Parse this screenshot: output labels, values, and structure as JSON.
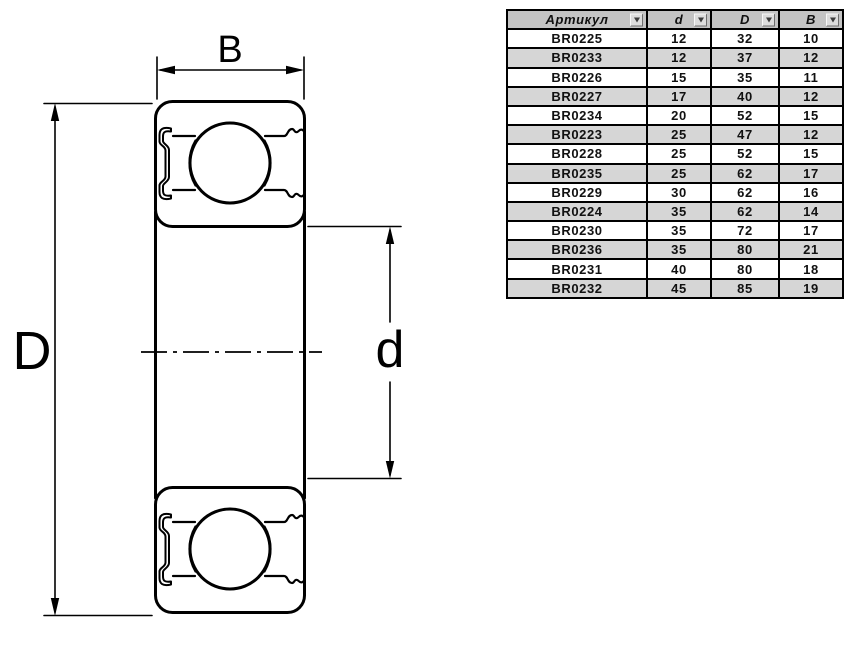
{
  "diagram": {
    "dimension_labels": {
      "width": "B",
      "outer_diameter": "D",
      "bore": "d"
    },
    "line_color": "#000000"
  },
  "table": {
    "columns": [
      "Артикул",
      "d",
      "D",
      "B"
    ],
    "rows": [
      [
        "BR0225",
        "12",
        "32",
        "10"
      ],
      [
        "BR0233",
        "12",
        "37",
        "12"
      ],
      [
        "BR0226",
        "15",
        "35",
        "11"
      ],
      [
        "BR0227",
        "17",
        "40",
        "12"
      ],
      [
        "BR0234",
        "20",
        "52",
        "15"
      ],
      [
        "BR0223",
        "25",
        "47",
        "12"
      ],
      [
        "BR0228",
        "25",
        "52",
        "15"
      ],
      [
        "BR0235",
        "25",
        "62",
        "17"
      ],
      [
        "BR0229",
        "30",
        "62",
        "16"
      ],
      [
        "BR0224",
        "35",
        "62",
        "14"
      ],
      [
        "BR0230",
        "35",
        "72",
        "17"
      ],
      [
        "BR0236",
        "35",
        "80",
        "21"
      ],
      [
        "BR0231",
        "40",
        "80",
        "18"
      ],
      [
        "BR0232",
        "45",
        "85",
        "19"
      ]
    ],
    "colors": {
      "header_bg": "#c4c4c4",
      "row_bg": "#ffffff",
      "row_alt_bg": "#d6d6d6",
      "border": "#000000"
    }
  }
}
